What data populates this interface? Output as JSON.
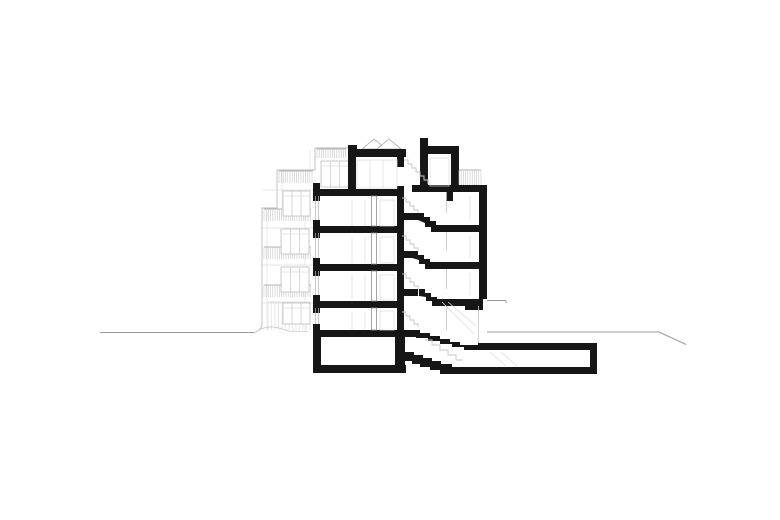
{
  "meta": {
    "drawing_type": "building-cross-section",
    "sheet_background": "#ffffff"
  },
  "palette": {
    "ink": "#161616",
    "mid": "#8e8e8e",
    "rail": "#b3b3b3",
    "light": "#c6c6c6",
    "faint": "#dcdcdc",
    "ground": "#9c9c9c",
    "white": "#ffffff"
  },
  "drawing": {
    "canvas": {
      "w": 780,
      "h": 520
    },
    "ground_lines": [
      [
        100,
        332.5,
        254,
        332.5
      ],
      [
        487,
        332,
        659,
        332
      ],
      [
        659,
        332,
        686,
        344.5
      ]
    ],
    "elevation": {
      "outline_path": "M352,148 L315,148 L315,170 L277,170 L277,208 L262,208 L262,326 Q259,331 254,333",
      "terrain_path": "M254,333 C262,327 272,325 282,329 C290,333 298,330 308,332",
      "level_lines": [
        [
          262,
          190,
          313,
          190
        ],
        [
          262,
          228,
          313,
          228
        ],
        [
          262,
          265,
          313,
          265
        ],
        [
          262,
          303,
          313,
          303
        ]
      ],
      "texture_lines": [
        [
          267,
          212,
          267,
          330
        ],
        [
          305,
          212,
          305,
          330
        ],
        [
          282,
          172,
          282,
          208
        ],
        [
          310,
          150,
          310,
          170
        ]
      ],
      "railing_hatches": [
        {
          "x": 317,
          "y": 149,
          "w": 29,
          "h": 9,
          "step": 2.2
        },
        {
          "x": 279,
          "y": 171,
          "w": 34,
          "h": 12,
          "step": 2.2
        },
        {
          "x": 264,
          "y": 209,
          "w": 47,
          "h": 12,
          "step": 2.2
        },
        {
          "x": 264,
          "y": 247,
          "w": 47,
          "h": 12,
          "step": 2.2
        },
        {
          "x": 264,
          "y": 285,
          "w": 47,
          "h": 12,
          "step": 2.2
        }
      ],
      "siding_hatch": {
        "x": 268,
        "y": 302,
        "w": 43,
        "h": 28,
        "step": 3.5
      },
      "windows": [
        {
          "x": 321,
          "y": 161,
          "w": 28,
          "h": 26
        },
        {
          "x": 283,
          "y": 191,
          "w": 27,
          "h": 25
        },
        {
          "x": 281,
          "y": 229,
          "w": 28,
          "h": 25
        },
        {
          "x": 281,
          "y": 267,
          "w": 28,
          "h": 25
        },
        {
          "x": 283,
          "y": 303,
          "w": 27,
          "h": 21
        }
      ]
    },
    "skylight": {
      "triangles": [
        [
          [
            362,
            149
          ],
          [
            374,
            139
          ],
          [
            386,
            149
          ]
        ],
        [
          [
            377,
            149
          ],
          [
            389,
            139
          ],
          [
            401,
            149
          ]
        ]
      ]
    },
    "section_rects": [
      [
        348,
        145,
        9,
        12
      ],
      [
        348,
        149,
        58,
        8
      ],
      [
        348,
        157,
        8,
        39
      ],
      [
        420,
        138,
        8,
        16
      ],
      [
        420,
        146,
        39,
        8
      ],
      [
        420,
        154,
        8,
        32
      ],
      [
        451,
        154,
        8,
        38
      ],
      [
        412,
        185,
        75,
        7
      ],
      [
        446,
        192,
        7,
        9
      ],
      [
        397,
        157,
        7,
        10
      ],
      [
        397,
        186,
        7,
        10
      ],
      [
        397,
        196,
        7,
        134
      ],
      [
        313,
        189,
        91,
        7
      ],
      [
        313,
        226,
        91,
        7
      ],
      [
        313,
        264,
        91,
        7
      ],
      [
        313,
        301,
        91,
        7
      ],
      [
        313,
        330,
        99,
        7
      ],
      [
        313,
        365,
        93,
        8
      ],
      [
        313,
        183,
        7,
        6
      ],
      [
        313,
        220,
        7,
        6
      ],
      [
        313,
        258,
        7,
        6
      ],
      [
        313,
        295,
        7,
        6
      ],
      [
        313,
        324,
        7,
        6
      ],
      [
        313,
        196,
        7,
        5
      ],
      [
        313,
        233,
        7,
        5
      ],
      [
        313,
        271,
        7,
        5
      ],
      [
        313,
        308,
        7,
        5
      ],
      [
        313,
        337,
        8,
        36
      ],
      [
        397,
        213,
        21,
        7
      ],
      [
        397,
        251,
        21,
        7
      ],
      [
        397,
        289,
        21,
        7
      ],
      [
        436,
        225,
        51,
        7
      ],
      [
        430,
        262,
        57,
        7
      ],
      [
        437,
        299,
        30,
        7
      ],
      [
        465,
        299,
        18,
        11
      ],
      [
        479,
        192,
        8,
        107
      ],
      [
        478,
        343,
        119,
        7
      ],
      [
        590,
        343,
        7,
        31
      ],
      [
        448,
        367,
        149,
        7
      ],
      [
        395,
        330,
        10,
        43
      ]
    ],
    "section_polys": [
      [
        [
          418,
          213
        ],
        [
          424,
          213
        ],
        [
          424,
          217
        ],
        [
          430,
          217
        ],
        [
          430,
          221
        ],
        [
          436,
          221
        ],
        [
          436,
          232
        ],
        [
          431,
          232
        ],
        [
          431,
          227
        ],
        [
          425,
          227
        ],
        [
          425,
          223
        ],
        [
          418,
          220
        ]
      ],
      [
        [
          412,
          251
        ],
        [
          418,
          251
        ],
        [
          418,
          255
        ],
        [
          424,
          255
        ],
        [
          424,
          259
        ],
        [
          430,
          259
        ],
        [
          430,
          269
        ],
        [
          425,
          269
        ],
        [
          425,
          264
        ],
        [
          419,
          264
        ],
        [
          419,
          260
        ],
        [
          412,
          258
        ]
      ],
      [
        [
          419,
          289
        ],
        [
          425,
          289
        ],
        [
          425,
          293
        ],
        [
          431,
          293
        ],
        [
          431,
          297
        ],
        [
          437,
          297
        ],
        [
          437,
          306
        ],
        [
          432,
          306
        ],
        [
          432,
          301
        ],
        [
          426,
          301
        ],
        [
          426,
          297
        ],
        [
          419,
          296
        ]
      ],
      [
        [
          410,
          330
        ],
        [
          420,
          330
        ],
        [
          420,
          333
        ],
        [
          430,
          333
        ],
        [
          430,
          336
        ],
        [
          440,
          336
        ],
        [
          440,
          339
        ],
        [
          450,
          339
        ],
        [
          450,
          342
        ],
        [
          460,
          342
        ],
        [
          460,
          345
        ],
        [
          478,
          345
        ],
        [
          478,
          350
        ],
        [
          464,
          350
        ],
        [
          464,
          347
        ],
        [
          452,
          347
        ],
        [
          452,
          344
        ],
        [
          440,
          344
        ],
        [
          440,
          341
        ],
        [
          428,
          341
        ],
        [
          428,
          338
        ],
        [
          416,
          338
        ],
        [
          416,
          337
        ],
        [
          410,
          337
        ]
      ],
      [
        [
          405,
          352
        ],
        [
          414,
          352
        ],
        [
          414,
          355
        ],
        [
          423,
          355
        ],
        [
          423,
          358
        ],
        [
          432,
          358
        ],
        [
          432,
          361
        ],
        [
          441,
          361
        ],
        [
          441,
          364
        ],
        [
          452,
          364
        ],
        [
          452,
          374
        ],
        [
          440,
          374
        ],
        [
          440,
          370
        ],
        [
          430,
          370
        ],
        [
          430,
          367
        ],
        [
          420,
          367
        ],
        [
          420,
          364
        ],
        [
          412,
          364
        ],
        [
          412,
          361
        ],
        [
          405,
          361
        ]
      ]
    ],
    "partitions": [
      [
        371.5,
        196,
        5,
        30
      ],
      [
        371.5,
        233,
        5,
        31
      ],
      [
        371.5,
        271,
        5,
        30
      ],
      [
        371.5,
        308,
        5,
        22
      ]
    ],
    "glazing_lines": [
      [
        315.5,
        196,
        315.5,
        220
      ],
      [
        318.5,
        196,
        318.5,
        220
      ],
      [
        315.5,
        233,
        315.5,
        258
      ],
      [
        318.5,
        233,
        318.5,
        258
      ],
      [
        315.5,
        271,
        315.5,
        295
      ],
      [
        318.5,
        271,
        318.5,
        295
      ],
      [
        315.5,
        308,
        315.5,
        324
      ],
      [
        318.5,
        308,
        318.5,
        324
      ]
    ],
    "interior_faint_rects": [
      [
        357,
        160,
        40,
        28
      ],
      [
        430,
        158,
        19,
        28
      ],
      [
        380,
        200,
        14,
        26
      ],
      [
        380,
        237,
        14,
        26
      ],
      [
        380,
        275,
        14,
        25
      ],
      [
        380,
        311,
        14,
        19
      ]
    ],
    "interior_faint_lines": [
      [
        370,
        160,
        370,
        188
      ],
      [
        383,
        160,
        383,
        188
      ],
      [
        352,
        200,
        352,
        226
      ],
      [
        365,
        200,
        365,
        226
      ],
      [
        352,
        237,
        352,
        263
      ],
      [
        365,
        237,
        365,
        263
      ],
      [
        352,
        275,
        352,
        300
      ],
      [
        365,
        275,
        365,
        300
      ],
      [
        352,
        312,
        352,
        329
      ],
      [
        365,
        312,
        365,
        329
      ],
      [
        470,
        196,
        470,
        221
      ],
      [
        470,
        236,
        470,
        258
      ],
      [
        470,
        273,
        470,
        295
      ],
      [
        442,
        302,
        474,
        334
      ],
      [
        448,
        302,
        476,
        326
      ],
      [
        490,
        352,
        506,
        366
      ],
      [
        501,
        352,
        517,
        366
      ]
    ],
    "stair_edge_lines": [
      [
        446.5,
        192,
        446.5,
        213
      ],
      [
        446.5,
        232,
        446.5,
        251
      ],
      [
        446.5,
        269,
        446.5,
        289
      ],
      [
        446.5,
        306,
        446.5,
        330
      ],
      [
        478.5,
        306,
        478.5,
        343
      ]
    ],
    "canopy_lines": [
      [
        487,
        300.5,
        506,
        300.5
      ],
      [
        506,
        300.5,
        506,
        303
      ]
    ],
    "flight_zigzags": [
      [
        [
          404,
          160
        ],
        [
          408,
          160
        ],
        [
          408,
          164
        ],
        [
          412,
          164
        ],
        [
          412,
          168
        ],
        [
          416,
          168
        ],
        [
          416,
          172
        ],
        [
          420,
          172
        ],
        [
          420,
          176
        ],
        [
          424,
          176
        ],
        [
          424,
          180
        ],
        [
          428,
          180
        ],
        [
          428,
          184
        ]
      ],
      [
        [
          402,
          198
        ],
        [
          406,
          198
        ],
        [
          406,
          202
        ],
        [
          410,
          202
        ],
        [
          410,
          206
        ],
        [
          414,
          206
        ],
        [
          414,
          210
        ],
        [
          418,
          210
        ],
        [
          418,
          213
        ]
      ],
      [
        [
          402,
          236
        ],
        [
          406,
          236
        ],
        [
          406,
          240
        ],
        [
          410,
          240
        ],
        [
          410,
          244
        ],
        [
          414,
          244
        ],
        [
          414,
          248
        ],
        [
          418,
          248
        ],
        [
          418,
          251
        ]
      ],
      [
        [
          402,
          274
        ],
        [
          406,
          274
        ],
        [
          406,
          278
        ],
        [
          410,
          278
        ],
        [
          410,
          282
        ],
        [
          414,
          282
        ],
        [
          414,
          286
        ],
        [
          418,
          286
        ],
        [
          418,
          289
        ]
      ],
      [
        [
          402,
          312
        ],
        [
          406,
          312
        ],
        [
          406,
          316
        ],
        [
          410,
          316
        ],
        [
          410,
          320
        ],
        [
          414,
          320
        ],
        [
          414,
          324
        ],
        [
          418,
          324
        ],
        [
          418,
          327
        ]
      ],
      [
        [
          425,
          340
        ],
        [
          432,
          340
        ],
        [
          432,
          345
        ],
        [
          440,
          345
        ],
        [
          440,
          350
        ],
        [
          448,
          350
        ],
        [
          448,
          355
        ],
        [
          456,
          355
        ],
        [
          456,
          360
        ],
        [
          463,
          360
        ]
      ]
    ],
    "terrace_railing_hatch": {
      "x": 459,
      "y": 170,
      "w": 22,
      "h": 15,
      "step": 2.2
    }
  }
}
